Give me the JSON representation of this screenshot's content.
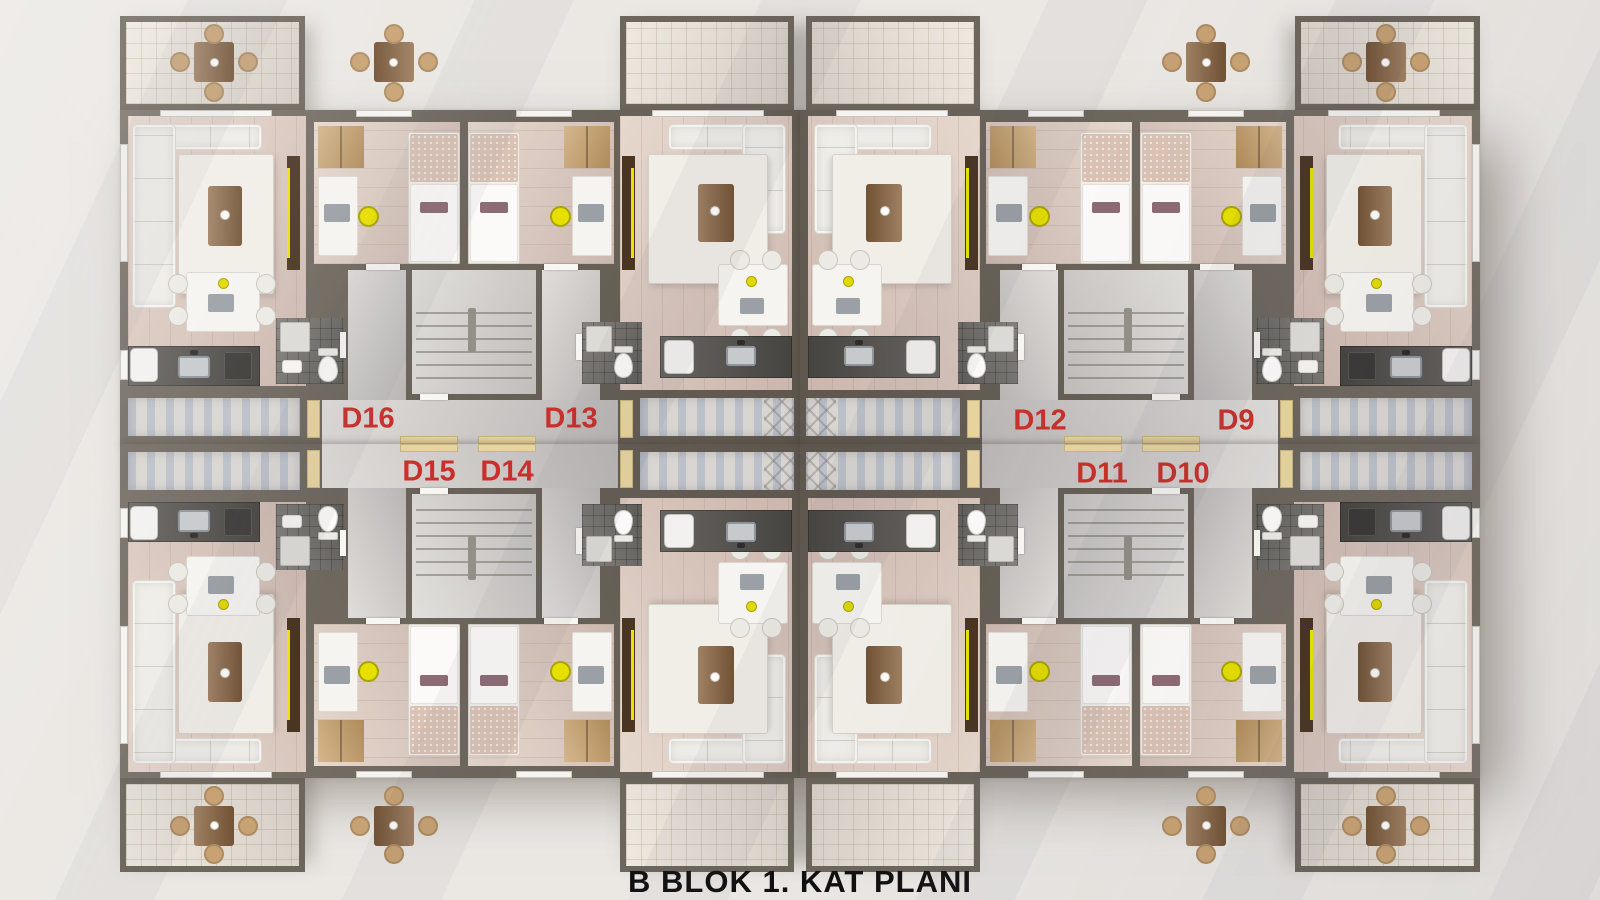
{
  "title": "B BLOK 1. KAT PLANI",
  "units": [
    {
      "label": "D16"
    },
    {
      "label": "D13"
    },
    {
      "label": "D12"
    },
    {
      "label": "D9"
    },
    {
      "label": "D15"
    },
    {
      "label": "D14"
    },
    {
      "label": "D11"
    },
    {
      "label": "D10"
    }
  ],
  "colors": {
    "background": "#ebe8e4",
    "wall": "#6a6258",
    "wood_floor": "#dcc7b8",
    "bath_tile": "#6f6c67",
    "corridor_concrete": "#cfcbc6",
    "balcony_tile": "#e8e1d3",
    "accent_yellow": "#e6df00",
    "unit_label_red": "#c9302b",
    "title_black": "#101010",
    "door_mat_beige": "#e7d49f"
  },
  "icons": {
    "sofa": "l-shaped-sofa",
    "bed": "single-bed",
    "chair_yellow": "desk-chair",
    "table_balcony": "outdoor-dining-table",
    "stairs": "stair-flight",
    "toilet": "toilet",
    "sink": "kitchen-sink"
  }
}
